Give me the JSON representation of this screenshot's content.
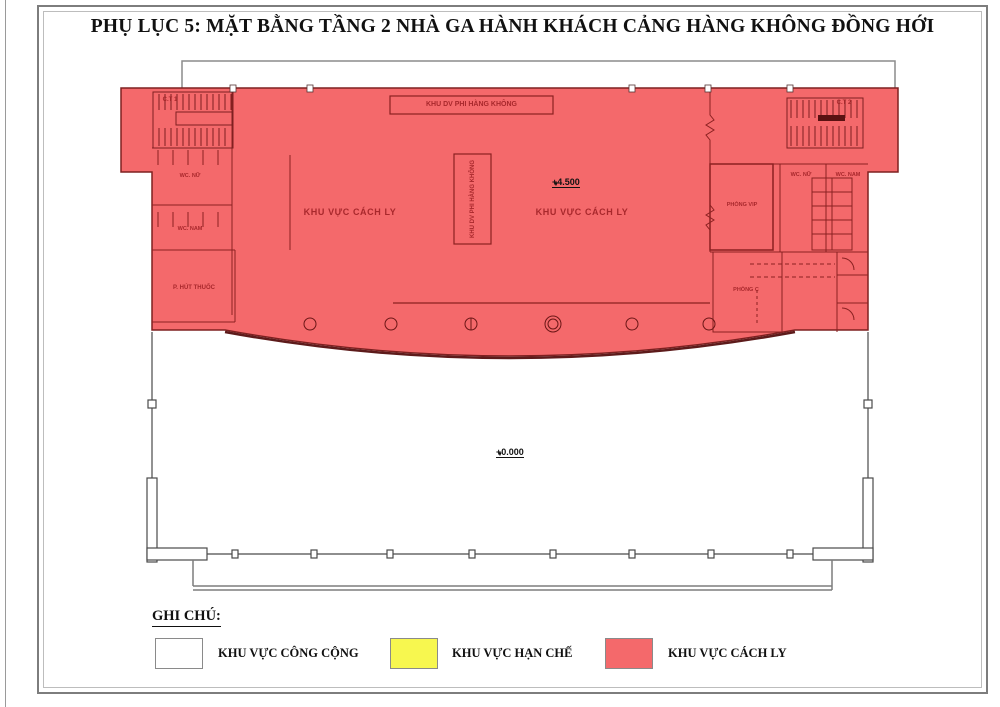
{
  "title": "PHỤ LỤC 5: MẶT BẰNG TẦNG 2 NHÀ GA HÀNH KHÁCH CẢNG HÀNG KHÔNG ĐỒNG HỚI",
  "colors": {
    "isolation_fill": "#F4696B",
    "isolation_stroke": "#7E2020",
    "restricted_fill": "#F7F74F",
    "public_fill": "#FFFFFF",
    "plan_label": "#A8282C"
  },
  "plan": {
    "rooms": {
      "stair_1": "C.T 1",
      "stair_2": "C.T 2",
      "wc_female_left": "WC. NỮ",
      "wc_male_left": "WC. NAM",
      "smoking_room": "P. HÚT THUỐC",
      "nonav_service_top": "KHU DV PHI HÀNG KHÔNG",
      "nonav_service_center": "KHU DV PHI HÀNG KHÔNG",
      "isolation_left": "KHU VỰC CÁCH LY",
      "isolation_right": "KHU VỰC CÁCH LY",
      "vip_room": "PHÒNG VIP",
      "wc_female_right": "WC. NỮ",
      "wc_male_right": "WC. NAM",
      "room_c": "PHÒNG C"
    },
    "levels": {
      "upper": "+4.500",
      "ground": "+0.000"
    }
  },
  "legend": {
    "title": "GHI CHÚ:",
    "items": [
      {
        "label": "KHU VỰC CÔNG CỘNG",
        "color": "#FFFFFF"
      },
      {
        "label": "KHU VỰC HẠN CHẾ",
        "color": "#F7F74F"
      },
      {
        "label": "KHU VỰC CÁCH LY",
        "color": "#F4696B"
      }
    ]
  }
}
